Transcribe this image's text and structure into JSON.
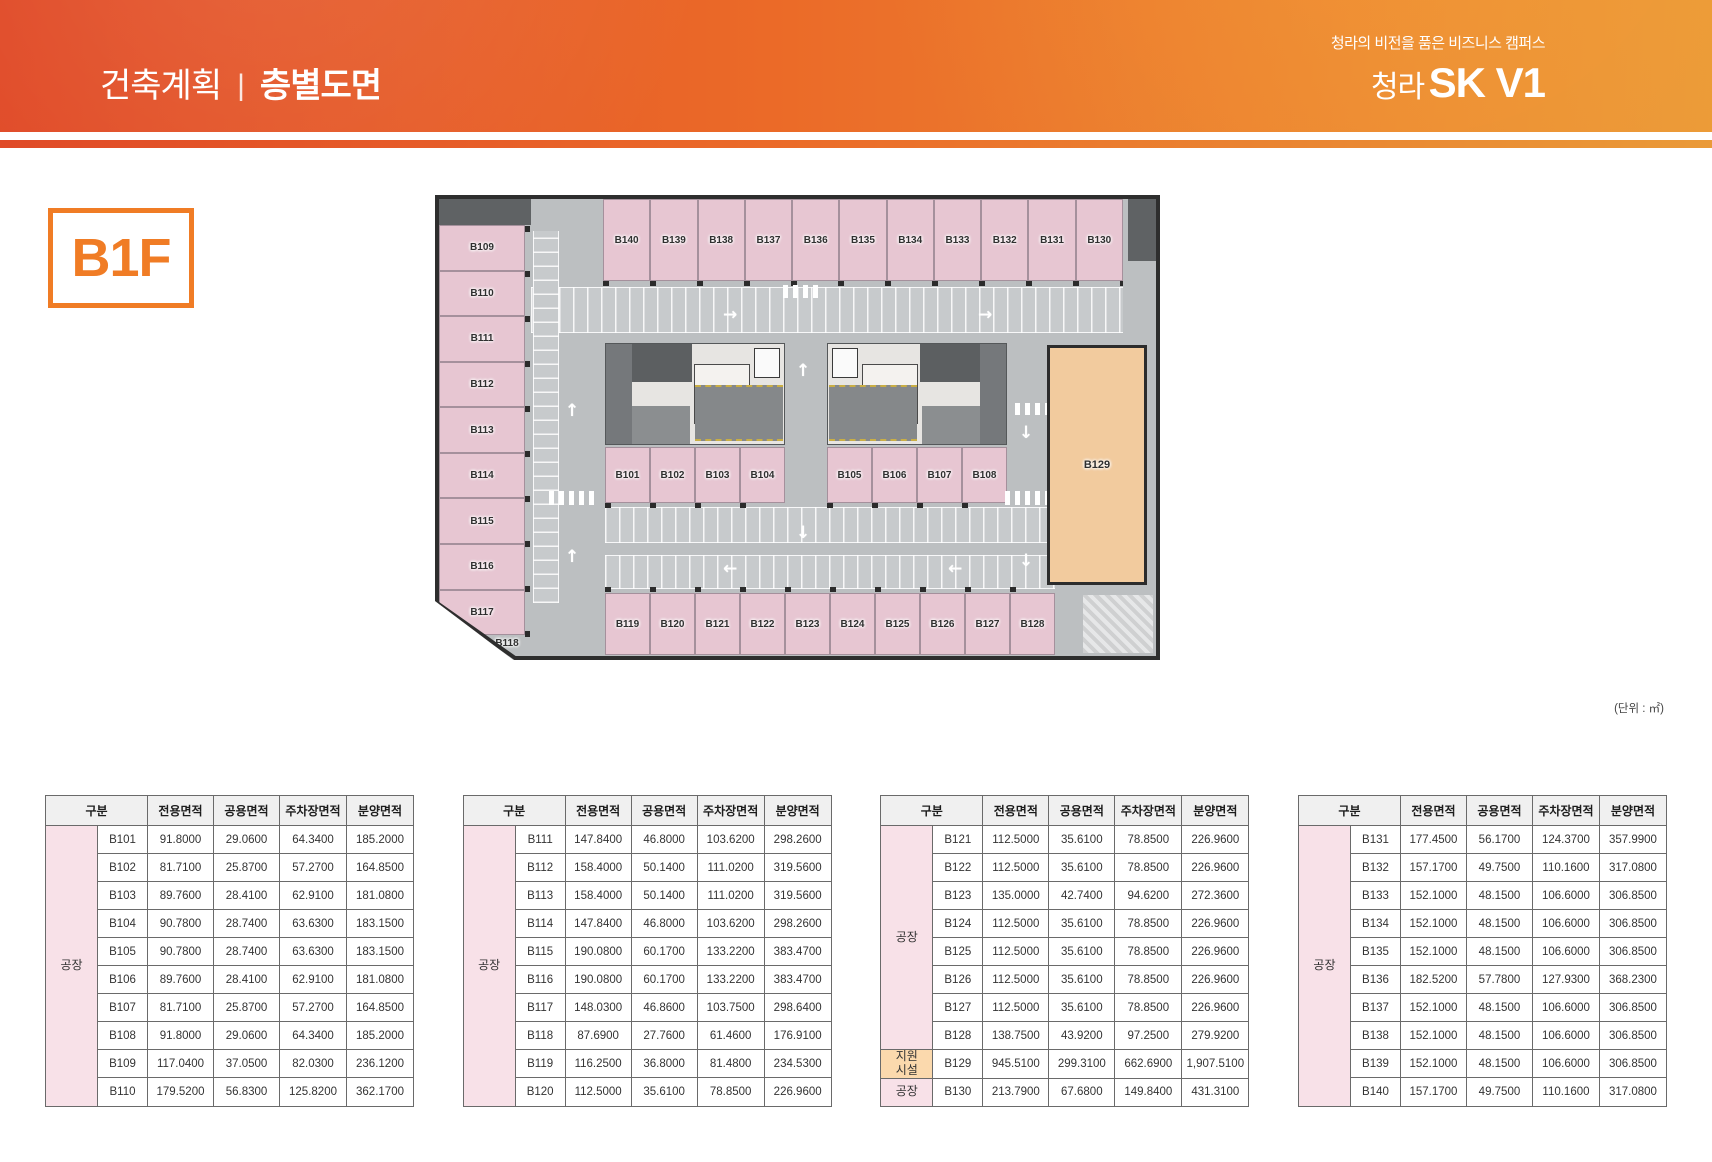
{
  "header": {
    "title_section": "건축계획",
    "title_divider": "|",
    "title_page": "층별도면",
    "tagline": "청라의 비전을 품은 비즈니스 캠퍼스",
    "brand_prefix": "청라",
    "brand_name": "SK V1"
  },
  "floor_label": "B1F",
  "unit_note": "(단위 : ㎡)",
  "colors": {
    "header_gradient_left": "#E04A27",
    "header_gradient_right": "#EA9A38",
    "accent_orange": "#F07C25",
    "unit_pink": "#E7C6D2",
    "unit_peach": "#F2CB9E",
    "table_category_pink": "#F8E1E8",
    "table_category_peach": "#FBD9AD",
    "plan_grey": "#BCBFC1"
  },
  "plan": {
    "left_units": [
      "B109",
      "B110",
      "B111",
      "B112",
      "B113",
      "B114",
      "B115",
      "B116",
      "B117"
    ],
    "diag_unit": "B118",
    "top_units": [
      "B140",
      "B139",
      "B138",
      "B137",
      "B136",
      "B135",
      "B134",
      "B133",
      "B132",
      "B131",
      "B130"
    ],
    "mid_left_units": [
      "B101",
      "B102",
      "B103",
      "B104"
    ],
    "mid_right_units": [
      "B105",
      "B106",
      "B107",
      "B108"
    ],
    "bottom_units": [
      "B119",
      "B120",
      "B121",
      "B122",
      "B123",
      "B124",
      "B125",
      "B126",
      "B127",
      "B128"
    ],
    "right_unit": "B129",
    "arrow_glyphs": {
      "up": "↑",
      "down": "↓",
      "left": "←",
      "right": "→"
    }
  },
  "table_headers": [
    "구분",
    "전용면적",
    "공용면적",
    "주차장면적",
    "분양면적"
  ],
  "tables": [
    {
      "groups": [
        {
          "label": "공장",
          "color": "pink",
          "count": 10
        }
      ],
      "rows": [
        {
          "unit": "B101",
          "values": [
            "91.8000",
            "29.0600",
            "64.3400",
            "185.2000"
          ]
        },
        {
          "unit": "B102",
          "values": [
            "81.7100",
            "25.8700",
            "57.2700",
            "164.8500"
          ]
        },
        {
          "unit": "B103",
          "values": [
            "89.7600",
            "28.4100",
            "62.9100",
            "181.0800"
          ]
        },
        {
          "unit": "B104",
          "values": [
            "90.7800",
            "28.7400",
            "63.6300",
            "183.1500"
          ]
        },
        {
          "unit": "B105",
          "values": [
            "90.7800",
            "28.7400",
            "63.6300",
            "183.1500"
          ]
        },
        {
          "unit": "B106",
          "values": [
            "89.7600",
            "28.4100",
            "62.9100",
            "181.0800"
          ]
        },
        {
          "unit": "B107",
          "values": [
            "81.7100",
            "25.8700",
            "57.2700",
            "164.8500"
          ]
        },
        {
          "unit": "B108",
          "values": [
            "91.8000",
            "29.0600",
            "64.3400",
            "185.2000"
          ]
        },
        {
          "unit": "B109",
          "values": [
            "117.0400",
            "37.0500",
            "82.0300",
            "236.1200"
          ]
        },
        {
          "unit": "B110",
          "values": [
            "179.5200",
            "56.8300",
            "125.8200",
            "362.1700"
          ]
        }
      ]
    },
    {
      "groups": [
        {
          "label": "공장",
          "color": "pink",
          "count": 10
        }
      ],
      "rows": [
        {
          "unit": "B111",
          "values": [
            "147.8400",
            "46.8000",
            "103.6200",
            "298.2600"
          ]
        },
        {
          "unit": "B112",
          "values": [
            "158.4000",
            "50.1400",
            "111.0200",
            "319.5600"
          ]
        },
        {
          "unit": "B113",
          "values": [
            "158.4000",
            "50.1400",
            "111.0200",
            "319.5600"
          ]
        },
        {
          "unit": "B114",
          "values": [
            "147.8400",
            "46.8000",
            "103.6200",
            "298.2600"
          ]
        },
        {
          "unit": "B115",
          "values": [
            "190.0800",
            "60.1700",
            "133.2200",
            "383.4700"
          ]
        },
        {
          "unit": "B116",
          "values": [
            "190.0800",
            "60.1700",
            "133.2200",
            "383.4700"
          ]
        },
        {
          "unit": "B117",
          "values": [
            "148.0300",
            "46.8600",
            "103.7500",
            "298.6400"
          ]
        },
        {
          "unit": "B118",
          "values": [
            "87.6900",
            "27.7600",
            "61.4600",
            "176.9100"
          ]
        },
        {
          "unit": "B119",
          "values": [
            "116.2500",
            "36.8000",
            "81.4800",
            "234.5300"
          ]
        },
        {
          "unit": "B120",
          "values": [
            "112.5000",
            "35.6100",
            "78.8500",
            "226.9600"
          ]
        }
      ]
    },
    {
      "groups": [
        {
          "label": "공장",
          "color": "pink",
          "count": 8
        },
        {
          "label": "지원\n시설",
          "color": "peach",
          "count": 1
        },
        {
          "label": "공장",
          "color": "pink",
          "count": 1
        }
      ],
      "rows": [
        {
          "unit": "B121",
          "values": [
            "112.5000",
            "35.6100",
            "78.8500",
            "226.9600"
          ]
        },
        {
          "unit": "B122",
          "values": [
            "112.5000",
            "35.6100",
            "78.8500",
            "226.9600"
          ]
        },
        {
          "unit": "B123",
          "values": [
            "135.0000",
            "42.7400",
            "94.6200",
            "272.3600"
          ]
        },
        {
          "unit": "B124",
          "values": [
            "112.5000",
            "35.6100",
            "78.8500",
            "226.9600"
          ]
        },
        {
          "unit": "B125",
          "values": [
            "112.5000",
            "35.6100",
            "78.8500",
            "226.9600"
          ]
        },
        {
          "unit": "B126",
          "values": [
            "112.5000",
            "35.6100",
            "78.8500",
            "226.9600"
          ]
        },
        {
          "unit": "B127",
          "values": [
            "112.5000",
            "35.6100",
            "78.8500",
            "226.9600"
          ]
        },
        {
          "unit": "B128",
          "values": [
            "138.7500",
            "43.9200",
            "97.2500",
            "279.9200"
          ]
        },
        {
          "unit": "B129",
          "values": [
            "945.5100",
            "299.3100",
            "662.6900",
            "1,907.5100"
          ]
        },
        {
          "unit": "B130",
          "values": [
            "213.7900",
            "67.6800",
            "149.8400",
            "431.3100"
          ]
        }
      ]
    },
    {
      "groups": [
        {
          "label": "공장",
          "color": "pink",
          "count": 10
        }
      ],
      "rows": [
        {
          "unit": "B131",
          "values": [
            "177.4500",
            "56.1700",
            "124.3700",
            "357.9900"
          ]
        },
        {
          "unit": "B132",
          "values": [
            "157.1700",
            "49.7500",
            "110.1600",
            "317.0800"
          ]
        },
        {
          "unit": "B133",
          "values": [
            "152.1000",
            "48.1500",
            "106.6000",
            "306.8500"
          ]
        },
        {
          "unit": "B134",
          "values": [
            "152.1000",
            "48.1500",
            "106.6000",
            "306.8500"
          ]
        },
        {
          "unit": "B135",
          "values": [
            "152.1000",
            "48.1500",
            "106.6000",
            "306.8500"
          ]
        },
        {
          "unit": "B136",
          "values": [
            "182.5200",
            "57.7800",
            "127.9300",
            "368.2300"
          ]
        },
        {
          "unit": "B137",
          "values": [
            "152.1000",
            "48.1500",
            "106.6000",
            "306.8500"
          ]
        },
        {
          "unit": "B138",
          "values": [
            "152.1000",
            "48.1500",
            "106.6000",
            "306.8500"
          ]
        },
        {
          "unit": "B139",
          "values": [
            "152.1000",
            "48.1500",
            "106.6000",
            "306.8500"
          ]
        },
        {
          "unit": "B140",
          "values": [
            "157.1700",
            "49.7500",
            "110.1600",
            "317.0800"
          ]
        }
      ]
    }
  ]
}
